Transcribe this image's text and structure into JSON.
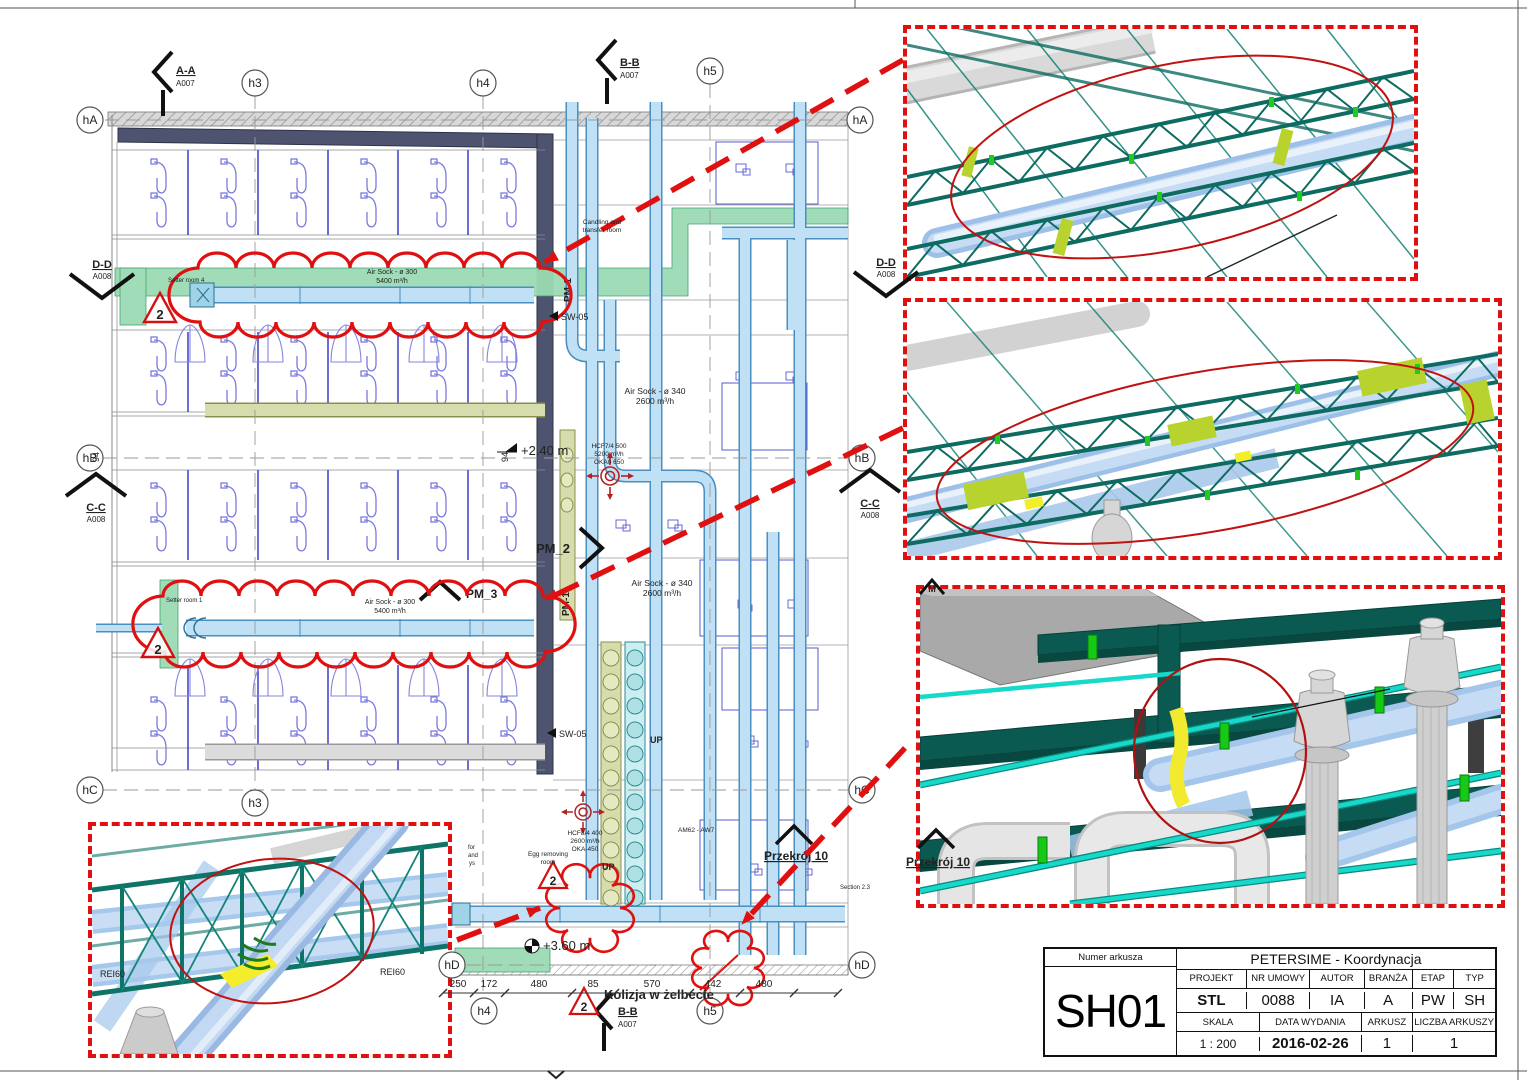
{
  "grid": {
    "hA": "hA",
    "hB": "hB",
    "hC": "hC",
    "hD": "hD",
    "h3": "h3",
    "h4": "h4",
    "h5": "h5"
  },
  "sections": {
    "aa": "A-A",
    "bb": "B-B",
    "cc": "C-C",
    "dd": "D-D",
    "refA007": "A007",
    "refA008": "A008",
    "pm1": "PM-1",
    "pm2": "PM_2",
    "pm3": "PM_3",
    "przekroj": "Przekrój 10",
    "m": "M"
  },
  "ducts": {
    "airsock300_1": "Air Sock - ø 300",
    "airsock300_2": "5400 m³/h",
    "airsock340_1": "Air Sock - ø 340",
    "airsock340_2": "2600 m³/h"
  },
  "rooms": {
    "setter4": "Setter room 4",
    "setter1": "Setter room 1",
    "candling1": "Candling and",
    "candling2": "transfer room",
    "egg1": "Egg removing",
    "egg2": "room"
  },
  "levels": {
    "l1": "+2.40 m",
    "l2": "+3.60 m"
  },
  "labels": {
    "sw05": "SW-05",
    "up": "UP",
    "am": "AM62 - AW7",
    "kolizja": "Kolizja w żelbecie",
    "rei60": "REI60",
    "rev": "2",
    "section23": "Section 2.3",
    "frag1": "for",
    "frag2": "and",
    "frag3": "ys"
  },
  "fan1": {
    "l1": "HCF7/4 500",
    "l2": "5200 m³/h",
    "l3": "OKA0 650"
  },
  "fan2": {
    "l1": "HCF8/4 400",
    "l2": "2600 m³/h",
    "l3": "OKA-450"
  },
  "dims": {
    "bottom": [
      "250",
      "172",
      "480",
      "85",
      "570",
      "442",
      "480"
    ],
    "v94": "94"
  },
  "titleblock": {
    "numer_label": "Numer arkusza",
    "sheet_no": "SH01",
    "title": "PETERSIME - Koordynacja",
    "h_projekt": "PROJEKT",
    "h_nr": "NR UMOWY",
    "h_autor": "AUTOR",
    "h_branza": "BRANŻA",
    "h_etap": "ETAP",
    "h_typ": "TYP",
    "v_projekt": "STL",
    "v_nr": "0088",
    "v_autor": "IA",
    "v_branza": "A",
    "v_etap": "PW",
    "v_typ": "SH",
    "h_skala": "SKALA",
    "h_data": "DATA WYDANIA",
    "h_arkusz": "ARKUSZ",
    "h_liczba": "LICZBA ARKUSZY",
    "v_skala": "1 : 200",
    "v_data": "2016-02-26",
    "v_arkusz": "1",
    "v_liczba": "1"
  },
  "colors": {
    "annotation_red": "#E01010",
    "duct_green": "#9ADBB4",
    "duct_blue": "#BFE0F5",
    "truss_teal": "#0E6E64",
    "highlight_chartreuse": "#C3D92E",
    "wall_navy": "#4E5470"
  }
}
